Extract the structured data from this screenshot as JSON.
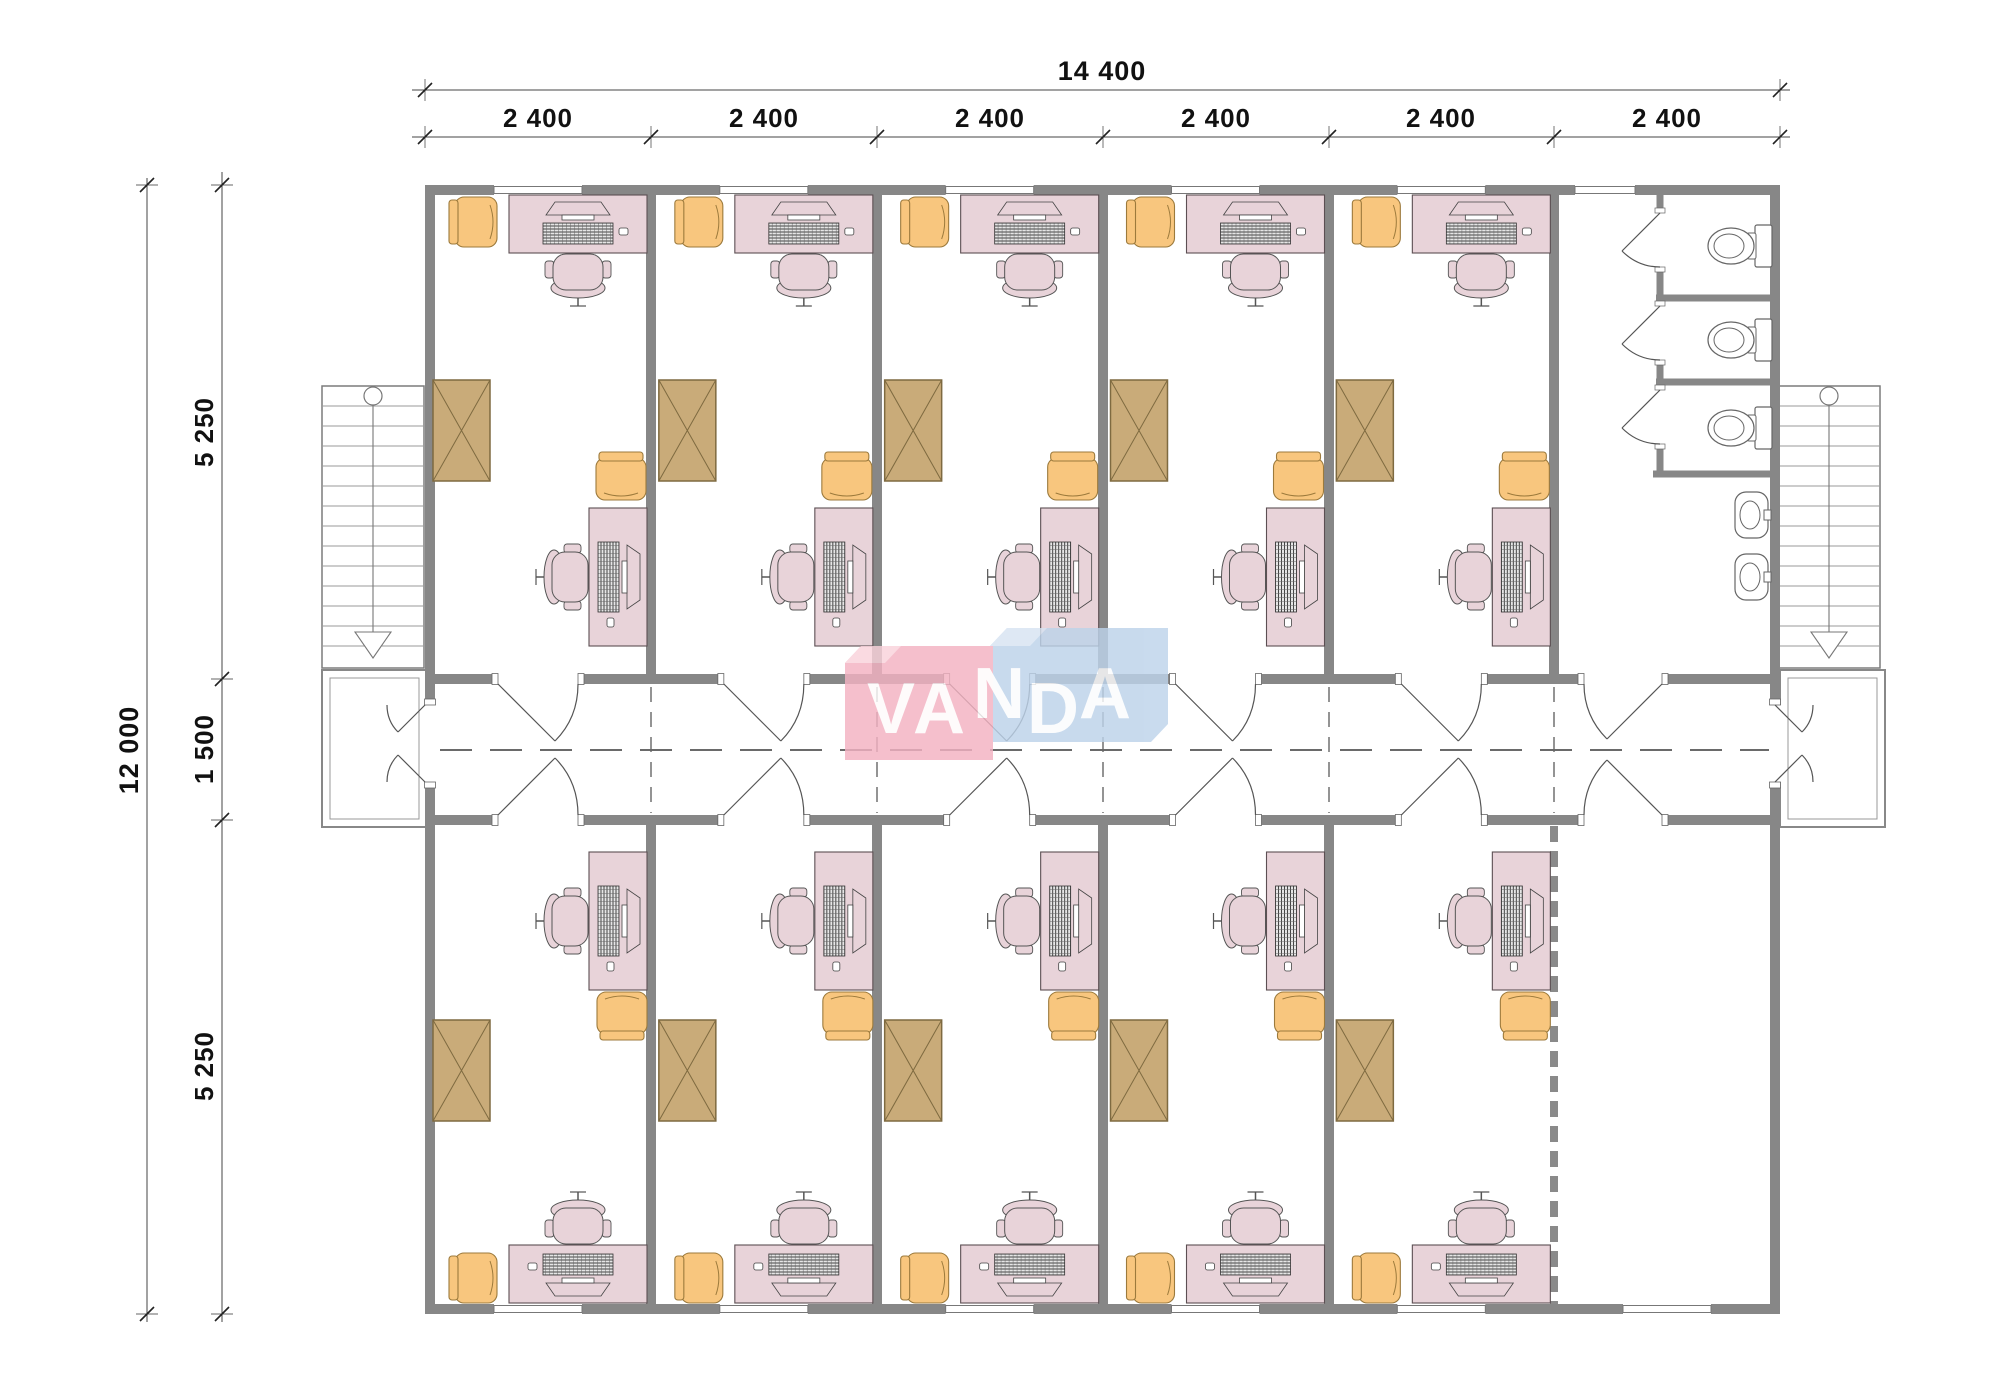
{
  "title": "Office building floor plan",
  "logo": {
    "name": "VANDA",
    "letters": [
      "V",
      "A",
      "N",
      "D",
      "A"
    ],
    "pink_block": "#f3b2c2",
    "blue_block": "#bdd3ea",
    "letter_color": "#ffffff"
  },
  "dimensions": {
    "top_total": "14 400",
    "top_segments": [
      "2 400",
      "2 400",
      "2 400",
      "2 400",
      "2 400",
      "2 400"
    ],
    "left_total": "12 000",
    "left_segments": [
      "5 250",
      "1 500",
      "5 250"
    ]
  },
  "layout": {
    "bays": 6,
    "top_offices": 5,
    "bottom_offices": 5,
    "toilet_stalls": 3,
    "sinks": 2,
    "stair_flights": 2
  },
  "colors": {
    "wall": "#878787",
    "desk": "#e8d3d9",
    "guest_chair": "#f8c67e",
    "cabinet": "#c9ab79",
    "plumbing_outline": "#666666",
    "dimension_line": "#444444",
    "dimension_text": "#111111"
  }
}
